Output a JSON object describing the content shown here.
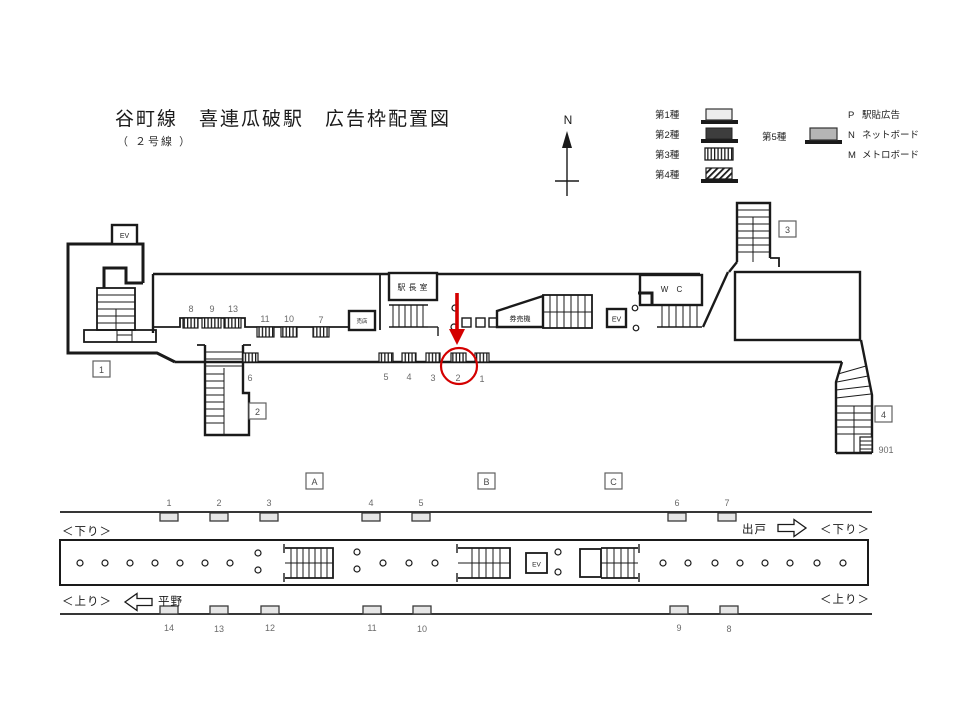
{
  "title": {
    "main": "谷町線　喜連瓜破駅　広告枠配置図",
    "sub": "（ ２号線 ）"
  },
  "compass": {
    "label": "N"
  },
  "legend": {
    "types": [
      {
        "label": "第1種",
        "style": "light"
      },
      {
        "label": "第2種",
        "style": "dark"
      },
      {
        "label": "第3種",
        "style": "vstripe"
      },
      {
        "label": "第4種",
        "style": "dstripe"
      },
      {
        "label": "第5種",
        "style": "gray"
      }
    ],
    "codes": [
      {
        "code": "P",
        "label": "駅貼広告"
      },
      {
        "code": "N",
        "label": "ネットボード"
      },
      {
        "code": "M",
        "label": "メトロボード"
      }
    ],
    "colors": {
      "light": "#ececec",
      "dark": "#3d3d3d",
      "gray": "#b5b5b5",
      "accent_red": "#d40000"
    }
  },
  "concourse": {
    "rooms": {
      "ev_upper": "EV",
      "ev_mid": "EV",
      "station_master": "駅長室",
      "kiosk": "売店",
      "ticket_machines": "券売機",
      "wc": "W C"
    },
    "exits": [
      {
        "num": "1"
      },
      {
        "num": "2"
      },
      {
        "num": "3"
      },
      {
        "num": "4"
      }
    ],
    "stair_label": "901",
    "upper_ads": [
      {
        "num": "8"
      },
      {
        "num": "9"
      },
      {
        "num": "13"
      },
      {
        "num": "11"
      },
      {
        "num": "10"
      },
      {
        "num": "7"
      }
    ],
    "lower_ads": [
      {
        "num": "6"
      },
      {
        "num": "5"
      },
      {
        "num": "4"
      },
      {
        "num": "3"
      },
      {
        "num": "2"
      },
      {
        "num": "1"
      }
    ],
    "highlight": {
      "circled_ad": "2",
      "color": "#d40000"
    }
  },
  "platform": {
    "sections": [
      {
        "label": "A"
      },
      {
        "label": "B"
      },
      {
        "label": "C"
      }
    ],
    "ev": "EV",
    "wall_ads_top": [
      {
        "num": "1"
      },
      {
        "num": "2"
      },
      {
        "num": "3"
      },
      {
        "num": "4"
      },
      {
        "num": "5"
      },
      {
        "num": "6"
      },
      {
        "num": "7"
      }
    ],
    "wall_ads_bottom": [
      {
        "num": "14"
      },
      {
        "num": "13"
      },
      {
        "num": "12"
      },
      {
        "num": "11"
      },
      {
        "num": "10"
      },
      {
        "num": "9"
      },
      {
        "num": "8"
      }
    ],
    "directions": {
      "down_left": "＜下り＞",
      "down_right": "＜下り＞",
      "up_left": "＜上り＞",
      "up_right": "＜上り＞",
      "next_down": "出戸",
      "next_up": "平野"
    }
  }
}
